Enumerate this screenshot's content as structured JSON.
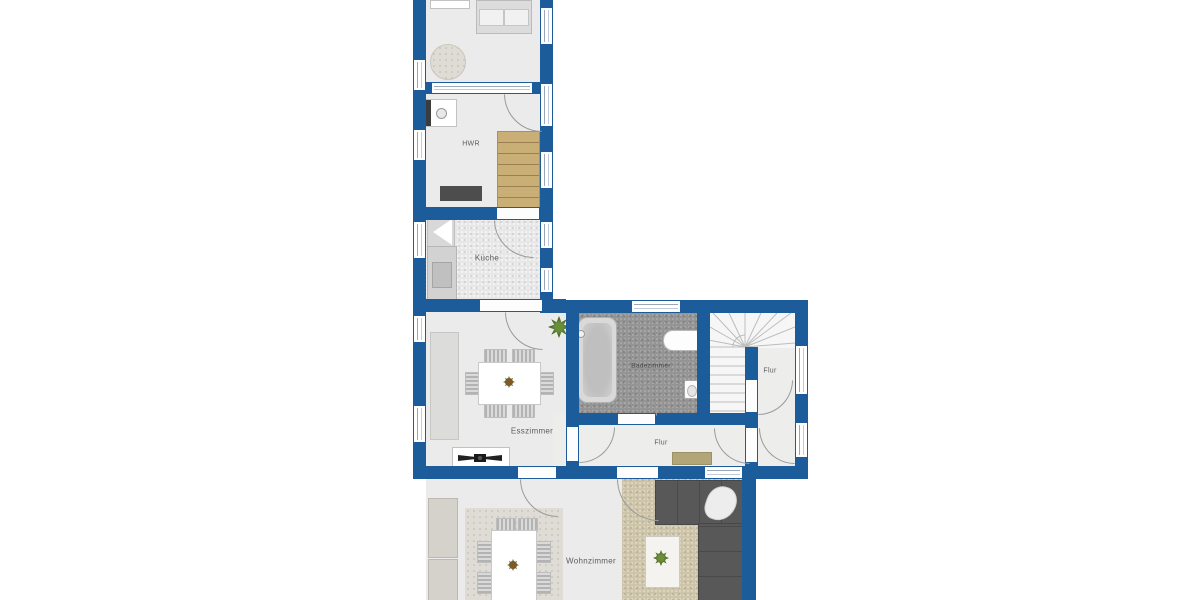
{
  "title": "Grundriss Erdgeschoss (floor plan)",
  "colors": {
    "wall": "#1d5c9a",
    "floor": "#ebebeb",
    "floor_hall": "#ededec",
    "tile_dark": "#949494",
    "stairs_wood": "#c9ae76",
    "rug_beige": "#cdc4aa",
    "rug_light": "#dedcd4",
    "sofa": "#585858",
    "counter_dark": "#4d4d4d",
    "doormat": "#b2a678",
    "furniture_gray": "#d6d6d6",
    "plant": "#41661f",
    "line": "#9a9a9a"
  },
  "rooms": {
    "hwr": {
      "label": "HWR"
    },
    "kueche": {
      "label": "Küche"
    },
    "esszimmer": {
      "label": "Esszimmer"
    },
    "badezimmer": {
      "label": "Badezimmer"
    },
    "flur_upper": {
      "label": "Flur"
    },
    "flur_lower": {
      "label": "Flur"
    },
    "wohnzimmer": {
      "label": "Wohnzimmer"
    }
  },
  "furniture": [
    "bed",
    "round-rug",
    "washing-machine",
    "hwr-counter",
    "straight-stairs",
    "fridge",
    "kitchen-counter",
    "sink",
    "dining-table",
    "dining-chairs",
    "plant",
    "sideboard-fan",
    "bathtub",
    "shower-sink",
    "toilet",
    "winder-stairs",
    "doormat",
    "cabinet",
    "living-table",
    "living-chairs",
    "l-sofa",
    "throw-blanket",
    "coffee-table",
    "beige-rug",
    "light-rug"
  ]
}
